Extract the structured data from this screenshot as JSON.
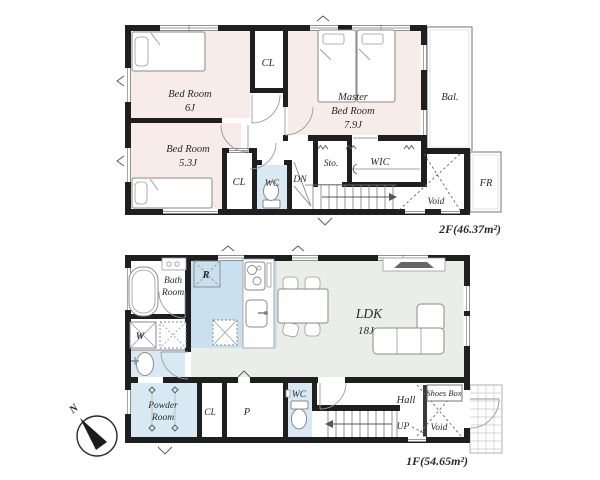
{
  "title": "2-story house floor plan",
  "colors": {
    "wall": "#1f1f1f",
    "bedroom_fill": "#f8ece8",
    "kitchen_fill": "#c9e0ee",
    "wet_area_fill": "#d8e9f3",
    "ldk_fill": "#ebeee8",
    "line": "#555555"
  },
  "floor2": {
    "area_label": "2F(46.37m²)",
    "rooms": {
      "bedroom6": {
        "name": "Bed Room",
        "size": "6J"
      },
      "bedroom5": {
        "name": "Bed Room",
        "size": "5.3J"
      },
      "master": {
        "name1": "Master",
        "name2": "Bed Room",
        "size": "7.9J"
      },
      "closet_top": {
        "label": "CL"
      },
      "closet_bottom": {
        "label": "CL"
      },
      "wc": {
        "label": "WC"
      },
      "stairs": {
        "label": "DN"
      },
      "storage": {
        "label": "Sto."
      },
      "wic": {
        "label": "WIC"
      },
      "void": {
        "label": "Void"
      },
      "free_room": {
        "label": "FR"
      },
      "balcony": {
        "label": "Bal."
      }
    }
  },
  "floor1": {
    "area_label": "1F(54.65m²)",
    "rooms": {
      "ldk": {
        "name": "LDK",
        "size": "18J"
      },
      "bath": {
        "name1": "Bath",
        "name2": "Room"
      },
      "refrigerator": {
        "label": "R"
      },
      "washer": {
        "label": "W"
      },
      "powder": {
        "name1": "Powder",
        "name2": "Room"
      },
      "closet": {
        "label": "CL"
      },
      "pantry": {
        "label": "P"
      },
      "wc": {
        "label": "WC"
      },
      "hall": {
        "label": "Hall"
      },
      "stairs": {
        "label": "UP"
      },
      "void": {
        "label": "Void"
      },
      "shoes_box": {
        "label": "Shoes Box"
      }
    }
  },
  "compass": {
    "label": "N"
  }
}
